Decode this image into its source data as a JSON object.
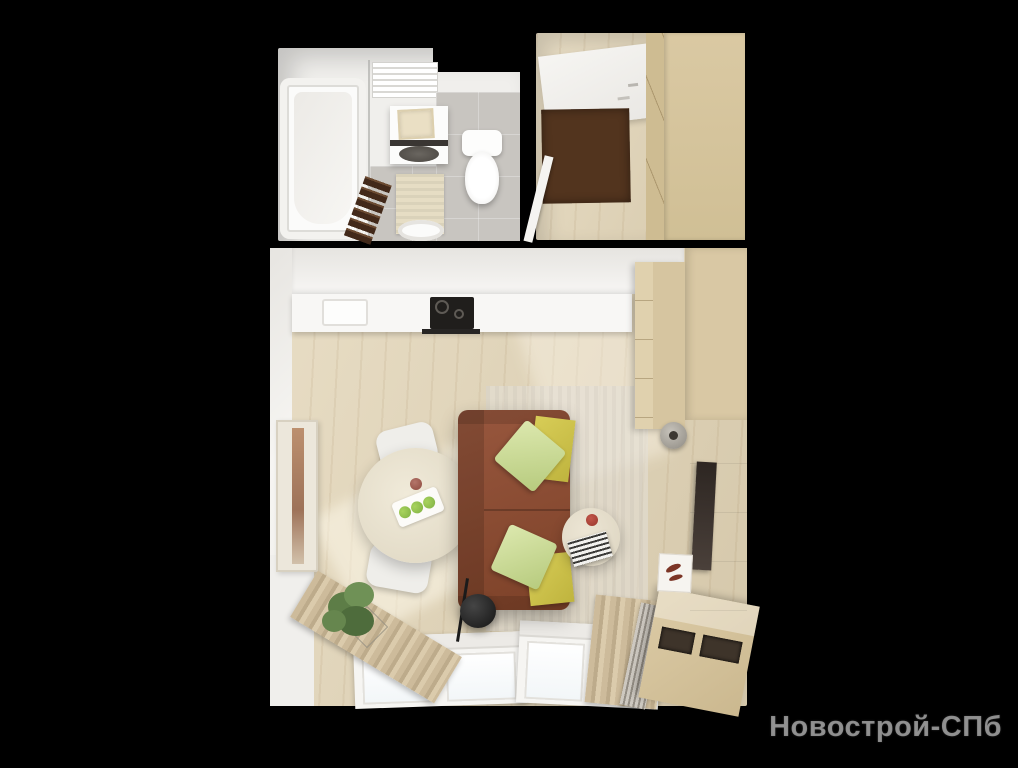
{
  "scene": {
    "type": "top-down 3d apartment floor plan render",
    "background_color": "#000000",
    "watermark": {
      "text": "Новострой-СПб"
    },
    "palette": {
      "wall_white": "#f5f4f1",
      "wood_floor": "#e2d4b5",
      "wardrobe_beige": "#d8c7a1",
      "tile_grey": "#c8c5c0",
      "sofa_brown": "#8a4a33",
      "pillow_green": "#cede9a",
      "blanket_yellow": "#d2c84e",
      "doormat_brown": "#52341e",
      "plant_green": "#5d7d47",
      "cooktop_black": "#201e1c"
    },
    "rooms": [
      {
        "id": "bathroom",
        "objects": [
          "bathtub",
          "shower-glass",
          "towel-radiator",
          "washing-machine",
          "laundry-basket",
          "toilet",
          "bath-mat",
          "towel-ladder",
          "sink"
        ]
      },
      {
        "id": "hallway",
        "objects": [
          "entrance-door",
          "doormat",
          "wardrobe",
          "banister"
        ]
      },
      {
        "id": "living-room-with-kitchen",
        "objects": [
          "kitchen-counter",
          "kitchen-sink",
          "cooktop",
          "dining-table",
          "chairs",
          "fruit-tray",
          "sofa",
          "pillows",
          "blankets",
          "floor-lamp",
          "side-table",
          "books",
          "rug",
          "tv-panel",
          "tv",
          "wall-clock",
          "decor-niche",
          "tv-bench",
          "radiator",
          "windows",
          "curtains",
          "plant",
          "picture-frame"
        ]
      }
    ]
  }
}
